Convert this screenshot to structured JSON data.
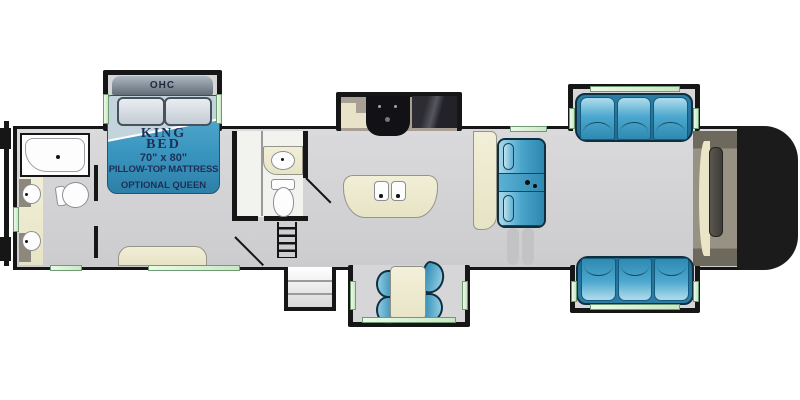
{
  "floorplan": {
    "description": "RV fifth-wheel floor plan, side-view top-down layout",
    "bed_slide": {
      "ohc_label": "OHC",
      "bed_line1": "KING",
      "bed_line2": "BED",
      "bed_size": "70\" x 80\"",
      "bed_mattress": "PILLOW-TOP MATTRESS",
      "bed_optional": "OPTIONAL QUEEN"
    },
    "rooms": {
      "rear": "master bathroom with shower, double-sink vanity, toilet",
      "bedroom": "king bed slide-out with overhead cabinet, dresser",
      "mid": "half bath with sink and toilet, stairs, entry door with steps",
      "kitchen": "kitchen slide-out with range, refrigerator, island with double sink",
      "living": "opposing sofa slide-outs, theater seating, dinette slide-out, front TV wardrobe"
    },
    "colors": {
      "wall": "#161616",
      "floor": "#d3d3d5",
      "furniture_blue": "#3b97c0",
      "window_green": "#d6eccf",
      "cream": "#eeebd2",
      "counter_tan": "#a8a095",
      "cap_black": "#1b1b1b",
      "bed_text_navy": "#1d2f57"
    }
  }
}
